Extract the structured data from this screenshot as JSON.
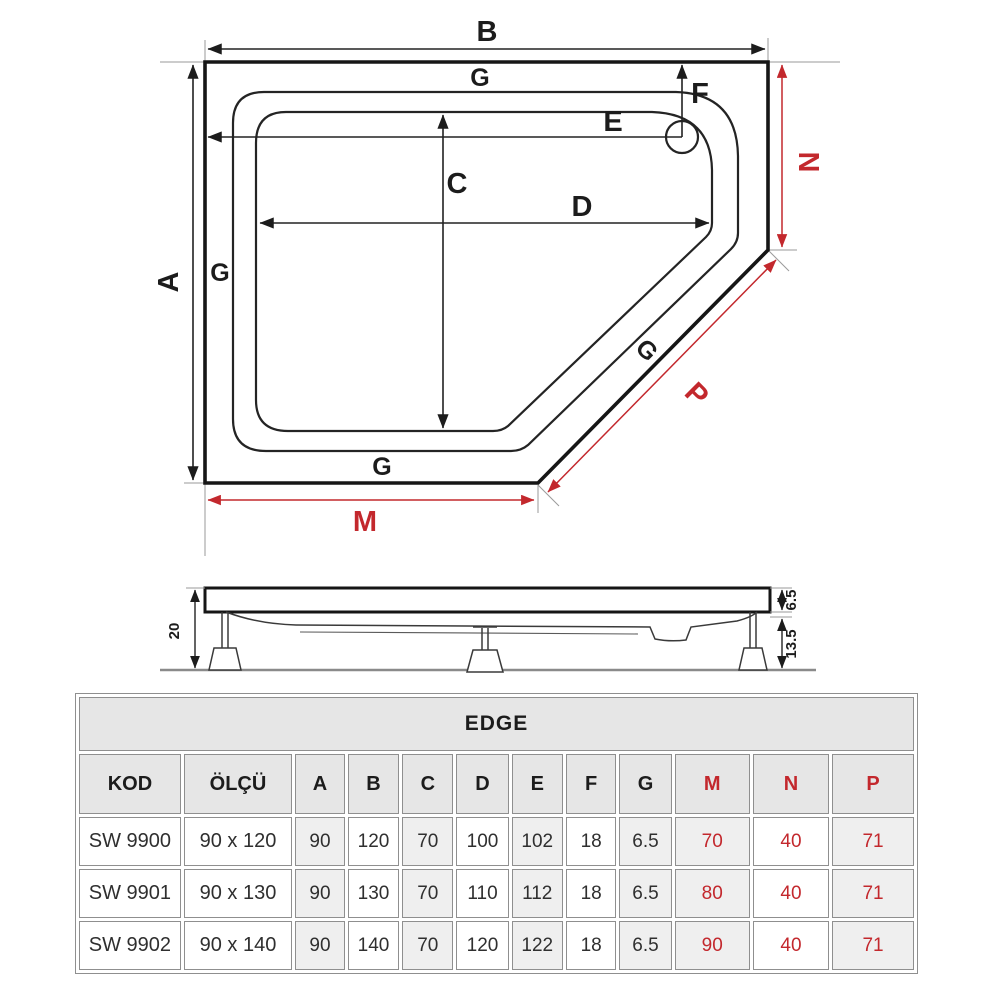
{
  "colors": {
    "accent_red": "#c3282d",
    "line_black": "#1c1c1c",
    "shade_gray": "#efefef",
    "header_gray": "#e6e6e6"
  },
  "plan": {
    "A": "A",
    "B": "B",
    "C": "C",
    "D": "D",
    "E": "E",
    "F": "F",
    "G": "G",
    "M": "M",
    "N": "N",
    "P": "P"
  },
  "side": {
    "total_height": "20",
    "rim_height": "6.5",
    "leg_height": "13.5"
  },
  "table": {
    "title": "EDGE",
    "columns": [
      "KOD",
      "ÖLÇÜ",
      "A",
      "B",
      "C",
      "D",
      "E",
      "F",
      "G",
      "M",
      "N",
      "P"
    ],
    "rows": [
      [
        "SW 9900",
        "90 x 120",
        "90",
        "120",
        "70",
        "100",
        "102",
        "18",
        "6.5",
        "70",
        "40",
        "71"
      ],
      [
        "SW 9901",
        "90 x 130",
        "90",
        "130",
        "70",
        "110",
        "112",
        "18",
        "6.5",
        "80",
        "40",
        "71"
      ],
      [
        "SW 9902",
        "90 x 140",
        "90",
        "140",
        "70",
        "120",
        "122",
        "18",
        "6.5",
        "90",
        "40",
        "71"
      ]
    ]
  }
}
